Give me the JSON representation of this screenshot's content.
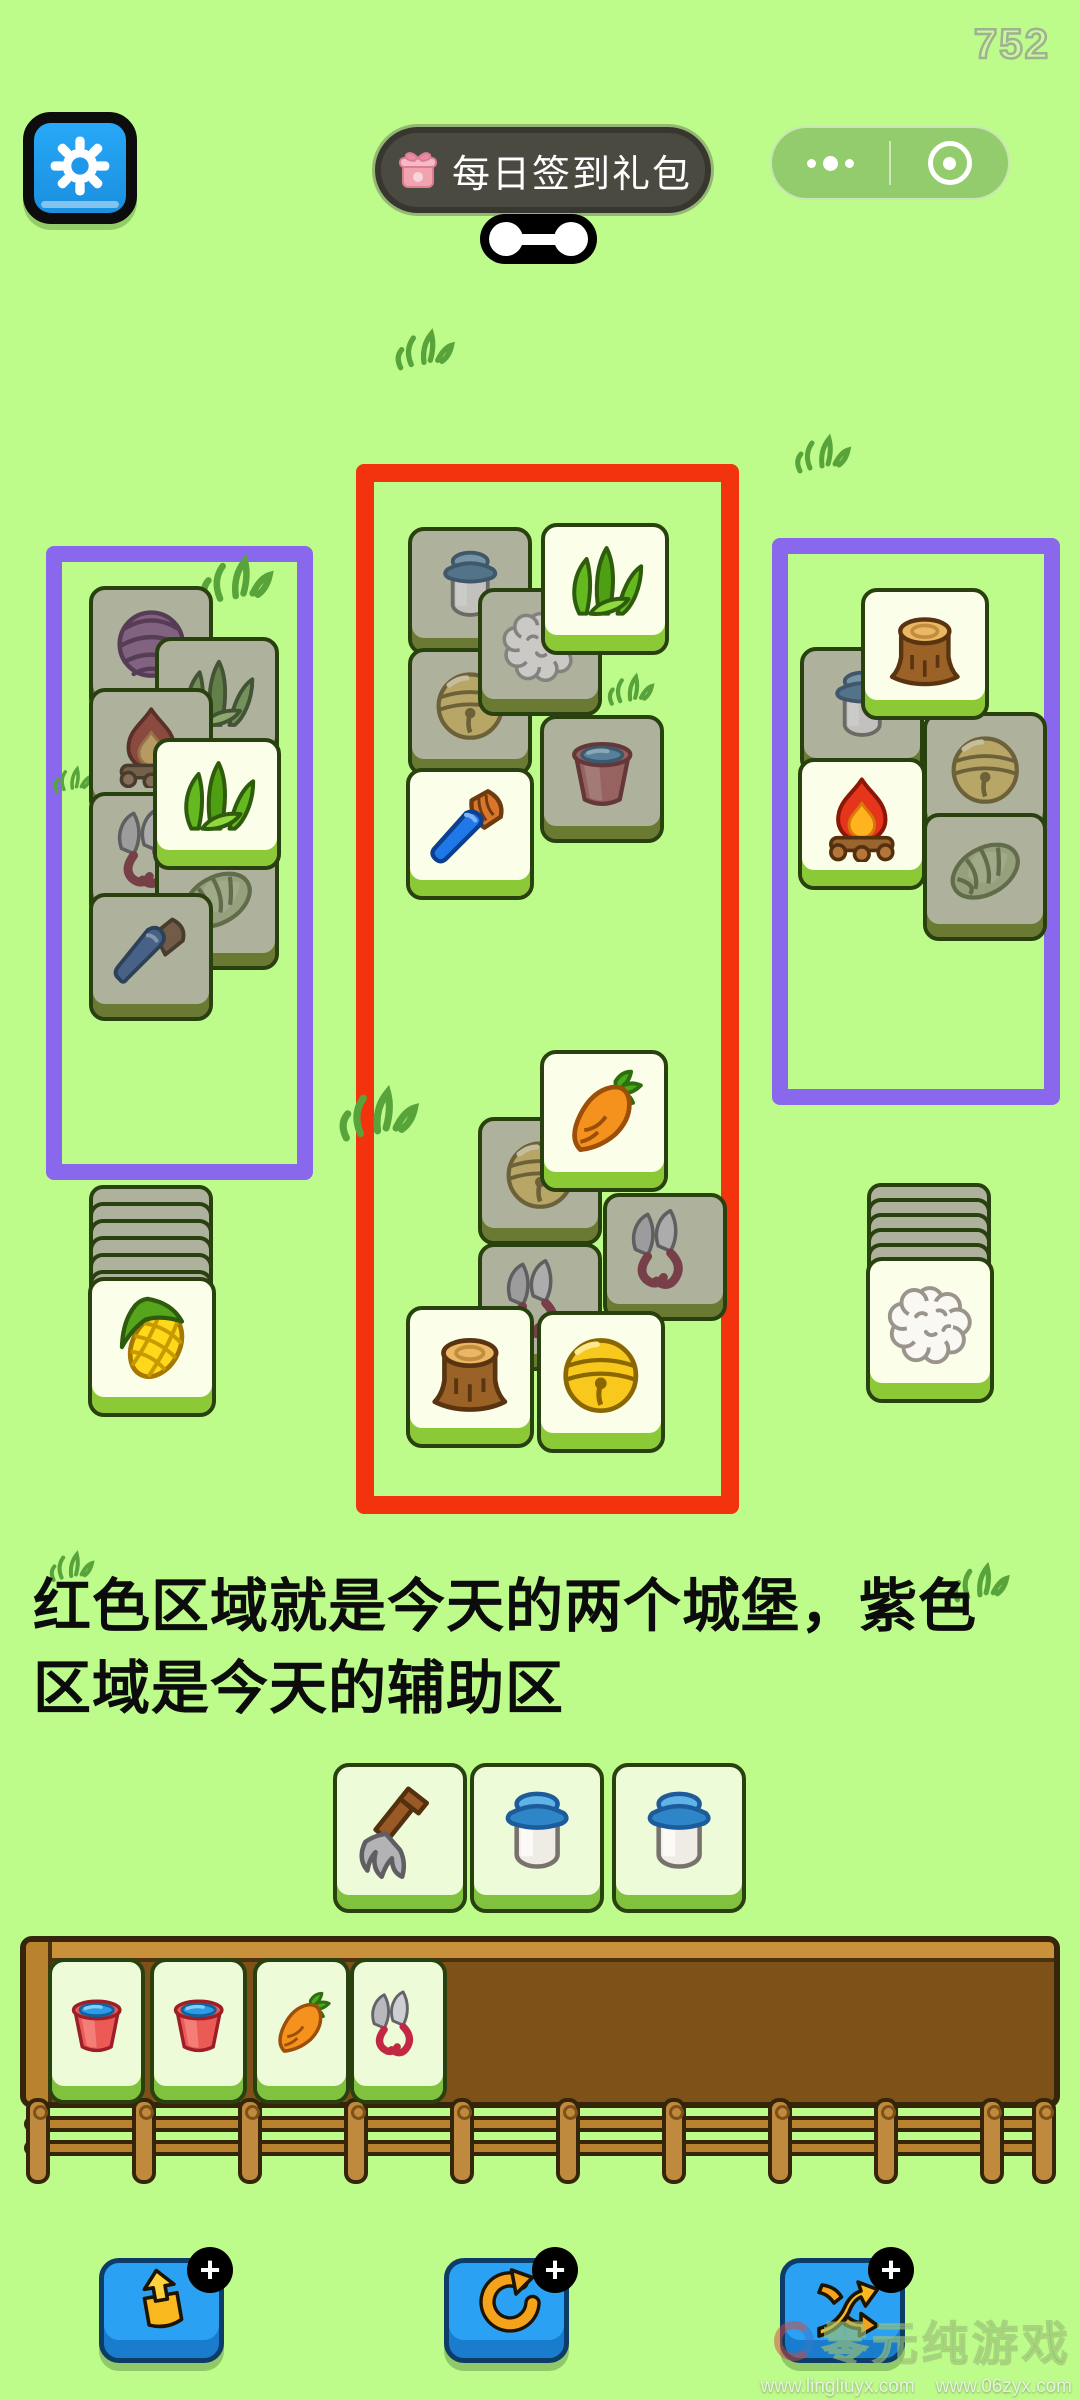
{
  "score": "752",
  "topbar": {
    "signin_label": "每日签到礼包",
    "capsule": {
      "more_icon": "more-dots-icon",
      "home_icon": "target-icon"
    }
  },
  "hint": {
    "line1": "红色区域就是今天的两个城堡，紫色",
    "line2": "区域是今天的辅助区"
  },
  "colors": {
    "background": "#bdfb8b",
    "castle_frame": "#f2330d",
    "aux_frame": "#8a68ee",
    "tile_covered": "#aeb29d",
    "tile_bright": "#fbffe9",
    "tray_wood": "#7d5117",
    "action_button": "#2aa1f2"
  },
  "frames": {
    "castle": {
      "x": 356,
      "y": 464,
      "w": 383,
      "h": 1050,
      "border": 18,
      "color": "#f2330d"
    },
    "aux_left": {
      "x": 46,
      "y": 546,
      "w": 267,
      "h": 634,
      "border": 16,
      "color": "#8a68ee"
    },
    "aux_right": {
      "x": 772,
      "y": 538,
      "w": 288,
      "h": 567,
      "border": 16,
      "color": "#8a68ee"
    }
  },
  "board": {
    "groups": [
      {
        "name": "aux-left",
        "tiles": [
          {
            "kind": "yarn",
            "state": "covered",
            "x": 89,
            "y": 586
          },
          {
            "kind": "grass",
            "state": "covered",
            "x": 155,
            "y": 637
          },
          {
            "kind": "fire",
            "state": "covered",
            "x": 89,
            "y": 688
          },
          {
            "kind": "shears",
            "state": "covered",
            "x": 89,
            "y": 792
          },
          {
            "kind": "lettuce",
            "state": "covered",
            "x": 155,
            "y": 842
          },
          {
            "kind": "knife",
            "state": "covered",
            "x": 89,
            "y": 893
          },
          {
            "kind": "grass",
            "state": "bright",
            "x": 153,
            "y": 738
          }
        ]
      },
      {
        "name": "aux-right",
        "tiles": [
          {
            "kind": "milk",
            "state": "covered",
            "x": 800,
            "y": 647
          },
          {
            "kind": "bell",
            "state": "covered",
            "x": 923,
            "y": 712
          },
          {
            "kind": "lettuce",
            "state": "covered",
            "x": 923,
            "y": 813
          },
          {
            "kind": "stump",
            "state": "bright",
            "x": 861,
            "y": 588
          },
          {
            "kind": "fire",
            "state": "bright",
            "x": 798,
            "y": 758
          }
        ]
      },
      {
        "name": "castle-top",
        "tiles": [
          {
            "kind": "milk",
            "state": "covered",
            "x": 408,
            "y": 527
          },
          {
            "kind": "bell",
            "state": "covered",
            "x": 408,
            "y": 648
          },
          {
            "kind": "bucket",
            "state": "covered",
            "x": 540,
            "y": 715
          },
          {
            "kind": "wool",
            "state": "covered",
            "x": 478,
            "y": 588
          },
          {
            "kind": "brush",
            "state": "bright",
            "x": 406,
            "y": 768
          },
          {
            "kind": "grass",
            "state": "bright",
            "x": 541,
            "y": 523
          }
        ]
      },
      {
        "name": "castle-bottom",
        "tiles": [
          {
            "kind": "bell",
            "state": "covered",
            "x": 478,
            "y": 1117
          },
          {
            "kind": "shears",
            "state": "covered",
            "x": 603,
            "y": 1193
          },
          {
            "kind": "shears",
            "state": "covered",
            "x": 478,
            "y": 1243
          },
          {
            "kind": "stump",
            "state": "bright",
            "x": 406,
            "y": 1306,
            "h": 142
          },
          {
            "kind": "bell",
            "state": "bright",
            "x": 537,
            "y": 1311,
            "h": 142
          },
          {
            "kind": "carrot",
            "state": "bright",
            "x": 540,
            "y": 1050,
            "h": 142
          }
        ]
      }
    ],
    "left_stack": {
      "x": 89,
      "y": 1185,
      "strips": 6,
      "step": 17,
      "front": {
        "kind": "corn",
        "state": "bright",
        "x": 88,
        "y": 1277,
        "h": 140
      }
    },
    "right_stack": {
      "x": 867,
      "y": 1183,
      "strips": 5,
      "step": 15,
      "front": {
        "kind": "wool",
        "state": "bright",
        "x": 866,
        "y": 1257,
        "h": 146
      }
    },
    "pending_row": {
      "y": 1763,
      "w": 134,
      "h": 150,
      "tiles": [
        {
          "kind": "fork",
          "x": 333
        },
        {
          "kind": "milk",
          "x": 470
        },
        {
          "kind": "milk",
          "x": 612
        }
      ]
    },
    "tray_slots": {
      "y": 1958,
      "w": 97,
      "h": 146,
      "tiles": [
        {
          "kind": "bucket",
          "x": 48
        },
        {
          "kind": "bucket",
          "x": 150
        },
        {
          "kind": "carrot",
          "x": 253
        },
        {
          "kind": "shears",
          "x": 350
        }
      ]
    }
  },
  "doodles": [
    {
      "x": 393,
      "y": 320,
      "w": 64
    },
    {
      "x": 793,
      "y": 426,
      "w": 60
    },
    {
      "x": 198,
      "y": 544,
      "w": 78
    },
    {
      "x": 52,
      "y": 760,
      "w": 42
    },
    {
      "x": 336,
      "y": 1074,
      "w": 86
    },
    {
      "x": 606,
      "y": 666,
      "w": 50
    },
    {
      "x": 48,
      "y": 1544,
      "w": 48
    },
    {
      "x": 950,
      "y": 1554,
      "w": 62
    }
  ],
  "action_buttons": [
    {
      "name": "takeout",
      "icon": "takeout-icon",
      "badge": "+"
    },
    {
      "name": "undo",
      "icon": "undo-icon",
      "badge": "+"
    },
    {
      "name": "shuffle",
      "icon": "shuffle-icon",
      "badge": "+"
    }
  ],
  "watermark": {
    "title": "零元纯游戏",
    "urls": "www.lingliuyx.com    www.06zyx.com"
  }
}
